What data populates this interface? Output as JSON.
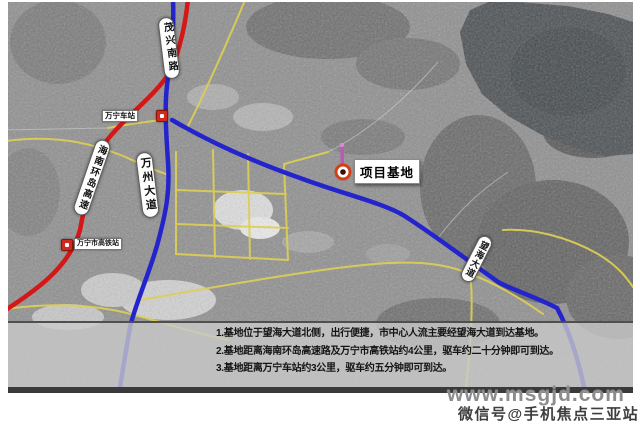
{
  "page": {
    "type": "project-location-satellite-map"
  },
  "map_labels": {
    "project_base": "项目基地",
    "roads": {
      "maoxing_south_road": "茂兴南路",
      "hainan_ring_expressway": "海南环岛高速",
      "wanzhou_avenue": "万州大道",
      "wanghai_avenue": "望海大道"
    },
    "stations": {
      "wanning_station": "万宁车站",
      "wanning_hsr_station": "万宁市高铁站"
    }
  },
  "info_panel": {
    "lines": [
      "1.基地位于望海大道北侧，出行便捷，市中心人流主要经望海大道到达基地。",
      "2.基地距离海南环岛高速路及万宁市高铁站约4公里，驱车约二十分钟即可到达。",
      "3.基地距离万宁车站约3公里，驱车约五分钟即可到达。"
    ]
  },
  "watermark": {
    "site": "www.msgjd.com",
    "wechat": "微信号@手机焦点三亚站"
  },
  "colors": {
    "road_blue": "#2424cc",
    "highway_red": "#d41717",
    "road_yellow": "#ddcf55",
    "water": "#4b4f52",
    "panel_bg": "#c8c8c8",
    "marker_ring": "#d04018",
    "marker_pin": "#b85ab8",
    "station_icon_red": "#cf2a1d"
  }
}
